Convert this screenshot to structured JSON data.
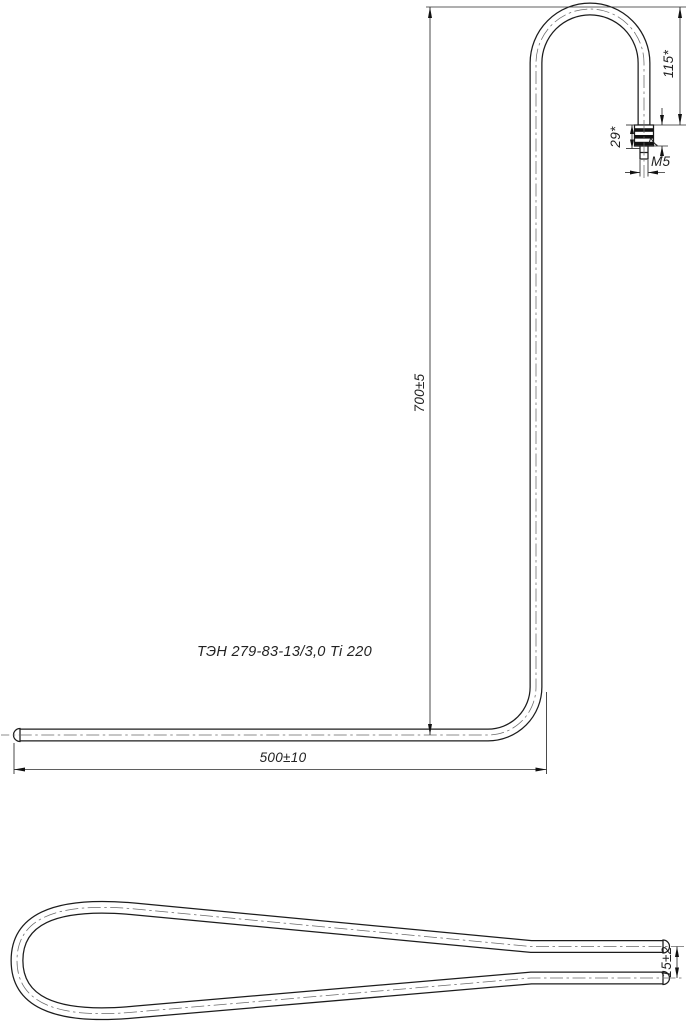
{
  "drawing": {
    "part_label": "ТЭН 279-83-13/3,0 Ti 220",
    "dimensions": {
      "height": "700±5",
      "length": "500±10",
      "hook_drop": "115*",
      "terminal_length": "29*",
      "thread_length": "7",
      "thread": "M5",
      "end_spacing": "15±2"
    },
    "colors": {
      "line": "#1c1c1c",
      "thin_line": "#2a2a2a",
      "centerline": "#6a6a6a",
      "background": "#ffffff"
    }
  }
}
